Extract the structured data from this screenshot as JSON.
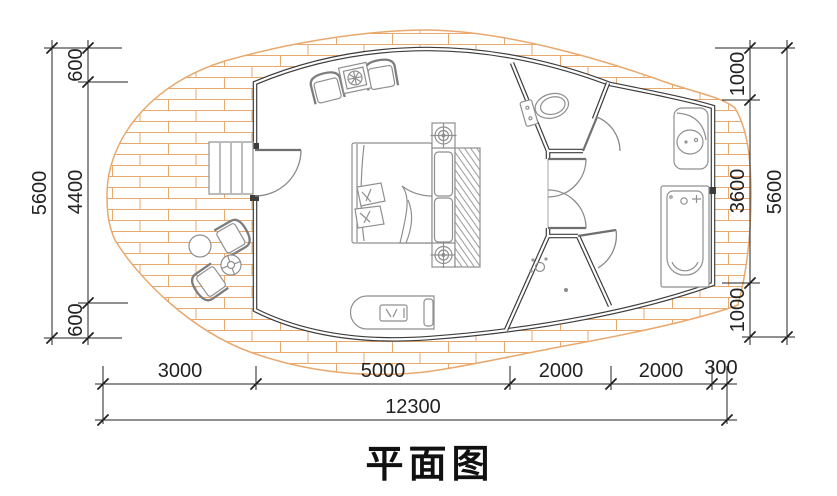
{
  "title": "平面图",
  "dimensions": {
    "left": {
      "overall": "5600",
      "segments": [
        "600",
        "4400",
        "600"
      ]
    },
    "right": {
      "overall": "5600",
      "segments": [
        "1000",
        "3600",
        "1000"
      ]
    },
    "bottom": {
      "overall": "12300",
      "segments": [
        "3000",
        "5000",
        "2000",
        "2000",
        "300"
      ]
    }
  },
  "colors": {
    "brick": "#e9a86d",
    "wall": "#3d3d3d",
    "furn": "#8f8f8f",
    "ink": "#222222"
  },
  "furniture": {
    "patio": "brick patio deck",
    "entry_steps": "entry steps",
    "entry_door": "entry door",
    "armchair_left": "armchair",
    "armchair_right": "armchair",
    "side_table": "side table",
    "bed": "double bed",
    "pillows": "pillows",
    "blanket": "blanket",
    "bedside_cabinet": "headboard cabinet",
    "ceiling_light": "ceiling light symbol",
    "wardrobe": "wardrobe",
    "bench": "bench console",
    "toilet": "toilet",
    "washbasin": "washbasin vanity",
    "bathtub": "bathtub",
    "shower": "shower head",
    "floor_drain": "floor drain",
    "outdoor_chair_1": "outdoor chair",
    "outdoor_chair_2": "outdoor chair",
    "outdoor_table": "outdoor round table",
    "parasol": "parasol table"
  }
}
